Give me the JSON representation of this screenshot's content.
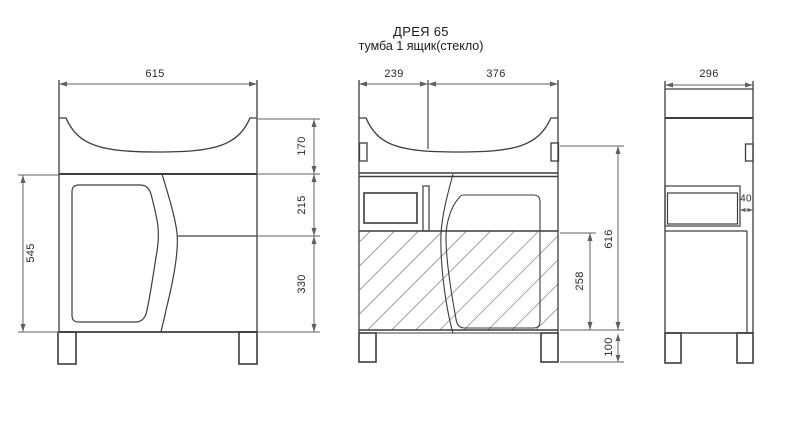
{
  "title": {
    "model": "ДРЕЯ 65",
    "subtitle": "тумба 1 ящик(стекло)"
  },
  "dimensions": {
    "front_width": "615",
    "front_body_height": "545",
    "front_sink_height": "170",
    "front_drawer_height": "215",
    "front_lower_height": "330",
    "mid_left_width": "239",
    "mid_right_width": "376",
    "mid_carcass_height": "616",
    "mid_hatch_height": "258",
    "mid_leg_height": "100",
    "side_depth": "296",
    "side_gap": "40"
  },
  "colors": {
    "body_line": "#3d3d3d",
    "dim_line": "#606060",
    "background": "#ffffff"
  }
}
